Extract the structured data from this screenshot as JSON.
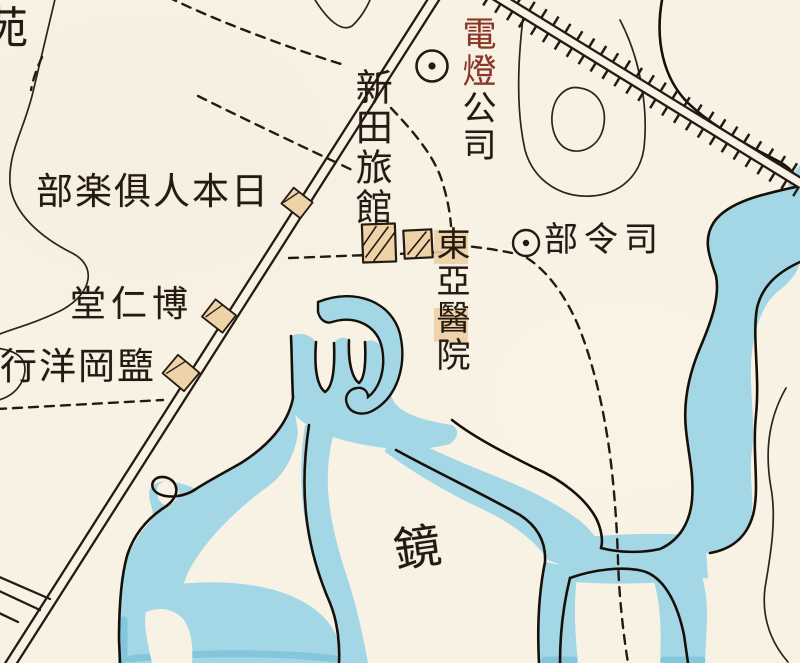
{
  "map": {
    "title": "historical-town-river-map",
    "labels": {
      "region_partial": "苑",
      "electric_company": {
        "red_part": "電燈",
        "black_part": "公司"
      },
      "nitta_inn": "新田旅館",
      "japanese_club": "部楽俱人本日",
      "headquarters": "部令司",
      "east_asia_hospital": "東亞醫院",
      "hakujindo_pharmacy": "堂仁博",
      "trading_company": "行洋岡盬",
      "river_name_char": "鏡"
    },
    "markers": {
      "circle_dot_electric": "circle-dot-marker",
      "circle_dot_headquarters": "circle-dot-marker",
      "hatched_building_large": "hatched-square-building",
      "hatched_building_small": "hatched-square-building",
      "club_building": "small-tan-building",
      "pharmacy_building": "small-tan-building",
      "trading_building": "small-tan-building"
    },
    "features": {
      "main_road": "double-line-road-diagonal",
      "railway_embankment": "double-line-with-tick-hatching",
      "paths": "dashed-footpaths",
      "river": "meandering-light-blue-river",
      "contours": "thin-terrain-contour-lines"
    },
    "colors": {
      "paper": "#f8f2e4",
      "water": "#a4d7e6",
      "water_deep": "#79c0d6",
      "ink": "#241a12",
      "red_label": "#8a3526",
      "building_fill": "#eed3a8"
    }
  }
}
